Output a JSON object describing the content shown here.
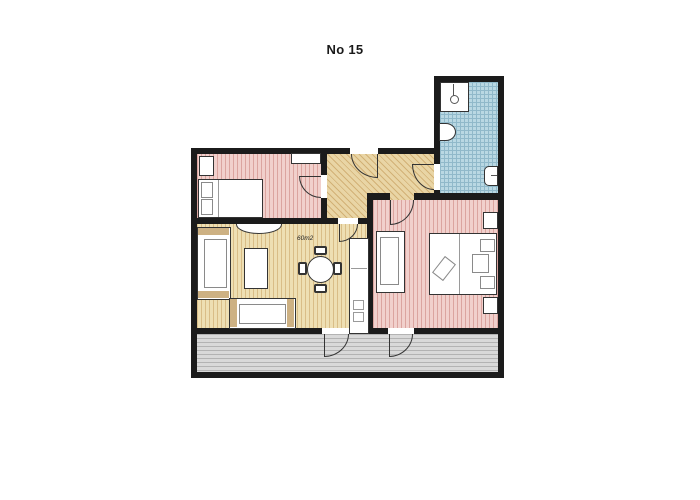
{
  "title": "No 15",
  "area_label": "60m2",
  "colors": {
    "wall": "#1b1b1b",
    "door_line": "#333333",
    "furniture_outline": "#333333",
    "armrest": "#cdb183",
    "bedroom_fill": "#f1d0cc",
    "bedroom_stripe": "#dba49f",
    "living_fill": "#eedfb3",
    "living_stripe": "#d9bd87",
    "hall_fill": "#e9d5a5",
    "hall_stripe": "#d2b176",
    "bath_fill": "#b9d8e3",
    "bath_stripe": "#90b9ca",
    "terrace_fill": "#d9d9d9",
    "terrace_stripe": "#b3b3b3"
  }
}
